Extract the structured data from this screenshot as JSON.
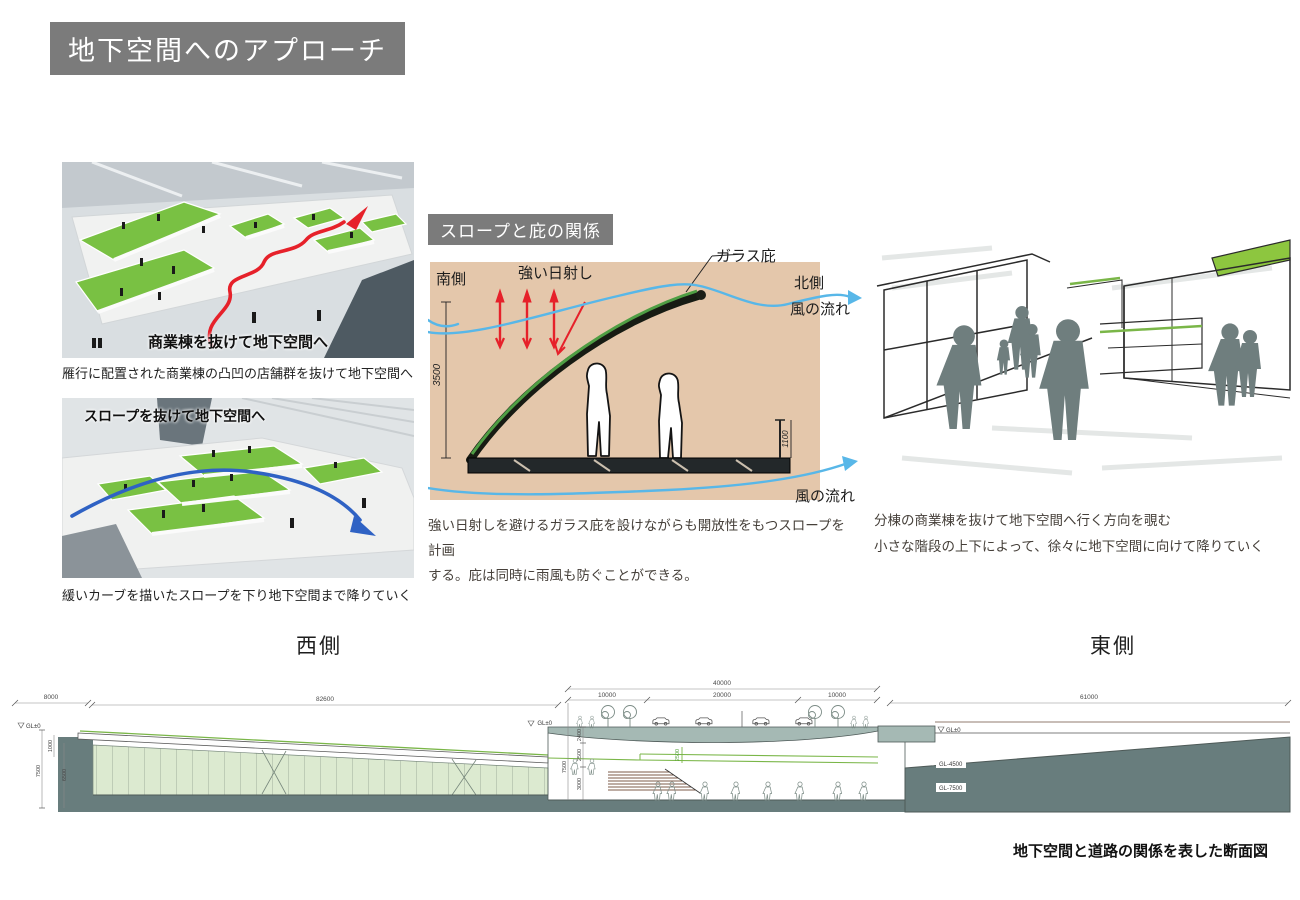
{
  "title_banner": "地下空間へのアプローチ",
  "photos": {
    "top": {
      "overlay": "商業棟を抜けて地下空間へ",
      "caption": "雁行に配置された商業棟の凸凹の店舗群を抜けて地下空間へ"
    },
    "bottom": {
      "overlay": "スロープを抜けて地下空間へ",
      "caption": "緩いカーブを描いたスロープを下り地下空間まで降りていく"
    }
  },
  "canopy": {
    "banner": "スロープと庇の関係",
    "south": "南側",
    "sun": "強い日射し",
    "glass": "ガラス庇",
    "north": "北側",
    "wind_top": "風の流れ",
    "wind_bottom": "風の流れ",
    "dim_h": "3500",
    "dim_rail": "1100",
    "desc1": "強い日射しを避けるガラス庇を設けながらも開放性をもつスロープを計画",
    "desc2": "する。庇は同時に雨風も防ぐことができる。"
  },
  "sketch": {
    "cap1": "分棟の商業棟を抜けて地下空間へ行く方向を覗む",
    "cap2": "小さな階段の上下によって、徐々に地下空間に向けて降りていく"
  },
  "section": {
    "west": "西側",
    "east": "東側",
    "caption": "地下空間と道路の関係を表した断面図",
    "d8000": "8000",
    "d82600": "82600",
    "d40000": "40000",
    "d10000a": "10000",
    "d20000": "20000",
    "d10000b": "10000",
    "d61000": "61000",
    "gl0a": "GL±0",
    "gl0b": "GL±0",
    "gl0c": "GL±0",
    "gl45": "GL-4500",
    "gl75": "GL-7500",
    "v1000": "1000",
    "v7500": "7500",
    "v6500": "6500",
    "v7500m": "7500",
    "v2400": "2400",
    "v2500": "2500",
    "v3000": "3000",
    "v2500g": "2500"
  },
  "colors": {
    "banner_gray": "#7b7b7b",
    "sketch_tan": "#e4c7ab",
    "model_green": "#79c143",
    "route_red": "#e6212a",
    "route_blue": "#2f62c4",
    "wind_blue": "#58b7e8",
    "ground_teal": "#687d7d",
    "deck_gray": "#a5b9b4",
    "accent_green": "#7ab648"
  }
}
